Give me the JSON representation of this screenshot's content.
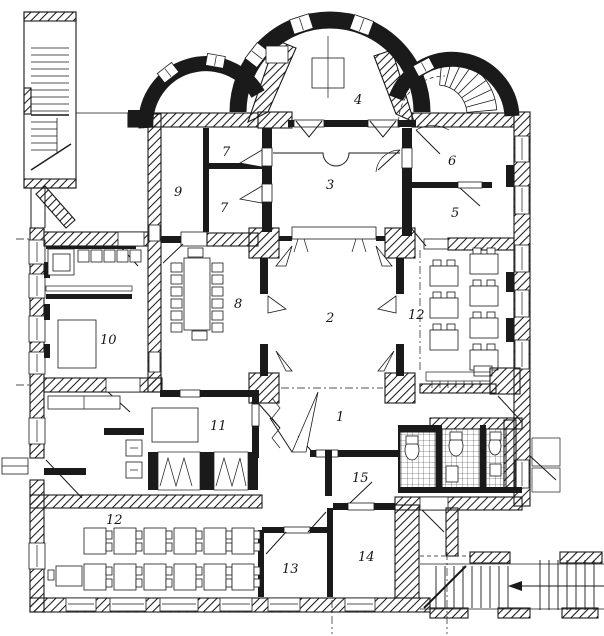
{
  "drawing": {
    "kind": "architectural floor plan (ground floor with trefoil apse)",
    "style": "black-and-white scanned ink drawing, hatched masonry walls",
    "paper_color": "#ffffff",
    "ink_color": "#1a1a1a"
  },
  "rooms": [
    {
      "label": "1"
    },
    {
      "label": "2"
    },
    {
      "label": "3"
    },
    {
      "label": "4"
    },
    {
      "label": "5"
    },
    {
      "label": "6"
    },
    {
      "label": "7"
    },
    {
      "label": "7"
    },
    {
      "label": "8"
    },
    {
      "label": "9"
    },
    {
      "label": "10"
    },
    {
      "label": "11"
    },
    {
      "label": "12"
    },
    {
      "label": "12"
    },
    {
      "label": "13"
    },
    {
      "label": "14"
    },
    {
      "label": "15"
    }
  ]
}
